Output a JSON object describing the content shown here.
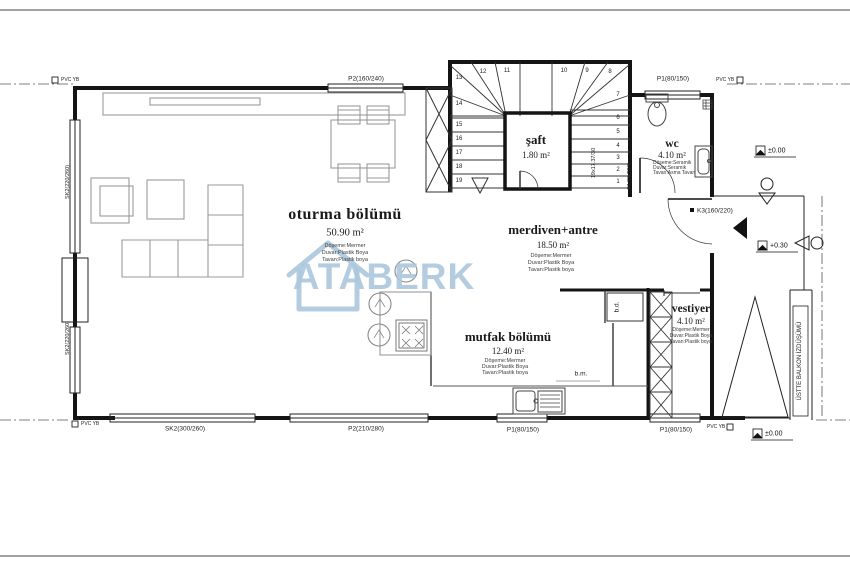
{
  "watermark": {
    "brand": "ATABERK"
  },
  "rooms": {
    "oturma": {
      "name": "oturma bölümü",
      "area": "50.90 m²",
      "floor": "Döşeme:Mermer",
      "wall": "Duvar:Plastik Boya",
      "ceiling": "Tavan:Plastik boya"
    },
    "merdiven": {
      "name": "merdiven+antre",
      "area": "18.50 m²",
      "floor": "Döşeme:Mermer",
      "wall": "Duvar:Plastik Boya",
      "ceiling": "Tavan:Plastik boya"
    },
    "mutfak": {
      "name": "mutfak bölümü",
      "area": "12.40 m²",
      "floor": "Döşeme:Mermer",
      "wall": "Duvar:Plastik Boya",
      "ceiling": "Tavan:Plastik boya"
    },
    "vestiyer": {
      "name": "vestiyer",
      "area": "4.10 m²",
      "floor": "Döşeme:Mermer",
      "wall": "Duvar:Plastik Boya",
      "ceiling": "Tavan:Plastik boya"
    },
    "wc": {
      "name": "wc",
      "area": "4.10 m²",
      "floor": "Döşeme:Seramik",
      "wall": "Duvar:Seramik",
      "ceiling": "Tavan:Asma Tavan"
    },
    "saft": {
      "name": "şaft",
      "area": "1.80 m²"
    }
  },
  "openings": {
    "p2_top": "P2(160/240)",
    "p1_top_right": "P1(80/150)",
    "sk2_left_upper": "SK2(220/260)",
    "sk2_left_lower": "SK2(220/260)",
    "sk2_bottom_left": "SK2(300/260)",
    "p2_bottom": "P2(210/280)",
    "p1_bottom_mid": "P1(80/150)",
    "p1_bottom_right": "P1(80/150)",
    "k1_wc_door": "K1(90/220)",
    "k3_entry_door": "K3(160/220)"
  },
  "levels": {
    "top": "±0.00",
    "entry": "+0.30",
    "bottom": "±0.00"
  },
  "notes": {
    "balcony_projection": "ÜSTTE BALKON İZDÜŞÜMÜ",
    "fridge": "b.d.",
    "dishwasher": "b.m.",
    "stair_calc": "19x17.37/30",
    "pvc_top_left": "PVC YB",
    "pvc_top_right": "PVC YB",
    "pvc_bottom_left": "PVC YB",
    "pvc_bottom_right": "PVC YB"
  },
  "stairs": {
    "numbers": [
      "1",
      "2",
      "3",
      "4",
      "5",
      "6",
      "7",
      "8",
      "9",
      "10",
      "11",
      "12",
      "13",
      "14",
      "15",
      "16",
      "17",
      "18",
      "19"
    ]
  }
}
